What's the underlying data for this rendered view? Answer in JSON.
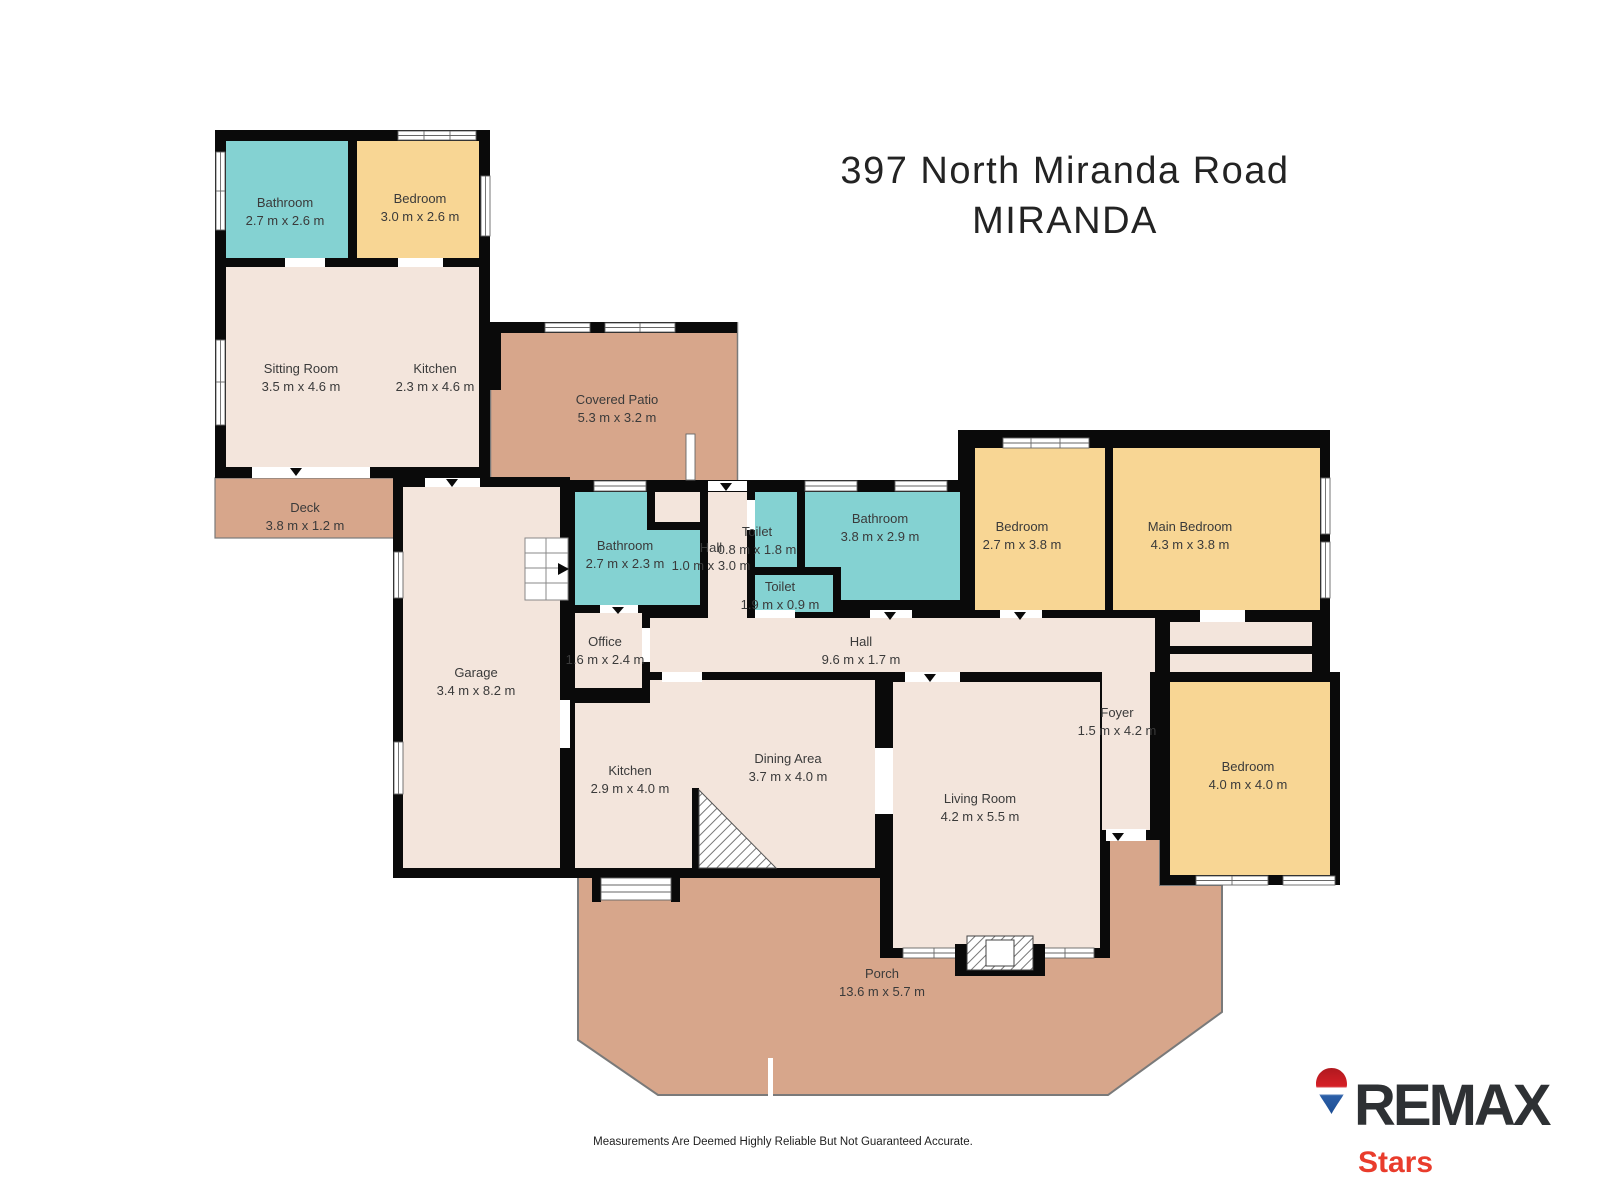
{
  "title": {
    "address": "397 North Miranda Road",
    "suburb": "MIRANDA"
  },
  "footer": {
    "disclaimer": "Measurements Are Deemed Highly Reliable But Not Guaranteed Accurate."
  },
  "logo": {
    "brand": "REMAX",
    "subbrand": "Stars"
  },
  "colors": {
    "wall": "#0a0a0a",
    "interior": "#f3e5dc",
    "wet_room": "#84d2d2",
    "bedroom": "#f8d694",
    "outdoor": "#d7a68b",
    "logo_text": "#2e3134",
    "logo_red": "#e93c2c",
    "balloon_red": "#d61f26",
    "balloon_blue": "#2459a5"
  },
  "rooms": [
    {
      "name": "Bathroom",
      "dims": "2.7 m x 2.6 m",
      "type": "wet_room"
    },
    {
      "name": "Bedroom",
      "dims": "3.0 m x 2.6 m",
      "type": "bedroom"
    },
    {
      "name": "Sitting Room",
      "dims": "3.5 m x 4.6 m",
      "type": "interior"
    },
    {
      "name": "Kitchen",
      "dims": "2.3 m x 4.6 m",
      "type": "interior"
    },
    {
      "name": "Covered Patio",
      "dims": "5.3 m x 3.2 m",
      "type": "outdoor"
    },
    {
      "name": "Deck",
      "dims": "3.8 m x 1.2 m",
      "type": "outdoor"
    },
    {
      "name": "Bathroom",
      "dims": "2.7 m x 2.3 m",
      "type": "wet_room"
    },
    {
      "name": "Hall",
      "dims": "1.0 m x 3.0 m",
      "type": "interior"
    },
    {
      "name": "Toilet",
      "dims": "0.8 m x 1.8 m",
      "type": "wet_room"
    },
    {
      "name": "Toilet",
      "dims": "1.9 m x 0.9 m",
      "type": "wet_room"
    },
    {
      "name": "Bathroom",
      "dims": "3.8 m x 2.9 m",
      "type": "wet_room"
    },
    {
      "name": "Bedroom",
      "dims": "2.7 m x 3.8 m",
      "type": "bedroom"
    },
    {
      "name": "Main Bedroom",
      "dims": "4.3 m x 3.8 m",
      "type": "bedroom"
    },
    {
      "name": "Garage",
      "dims": "3.4 m x 8.2 m",
      "type": "interior"
    },
    {
      "name": "Office",
      "dims": "1.6 m x 2.4 m",
      "type": "interior"
    },
    {
      "name": "Hall",
      "dims": "9.6 m x 1.7 m",
      "type": "interior"
    },
    {
      "name": "Kitchen",
      "dims": "2.9 m x 4.0 m",
      "type": "interior"
    },
    {
      "name": "Dining Area",
      "dims": "3.7 m x 4.0 m",
      "type": "interior"
    },
    {
      "name": "Living Room",
      "dims": "4.2 m x 5.5 m",
      "type": "interior"
    },
    {
      "name": "Foyer",
      "dims": "1.5 m x 4.2 m",
      "type": "interior"
    },
    {
      "name": "Bedroom",
      "dims": "4.0 m x 4.0 m",
      "type": "bedroom"
    },
    {
      "name": "Porch",
      "dims": "13.6 m x 5.7 m",
      "type": "outdoor"
    }
  ]
}
